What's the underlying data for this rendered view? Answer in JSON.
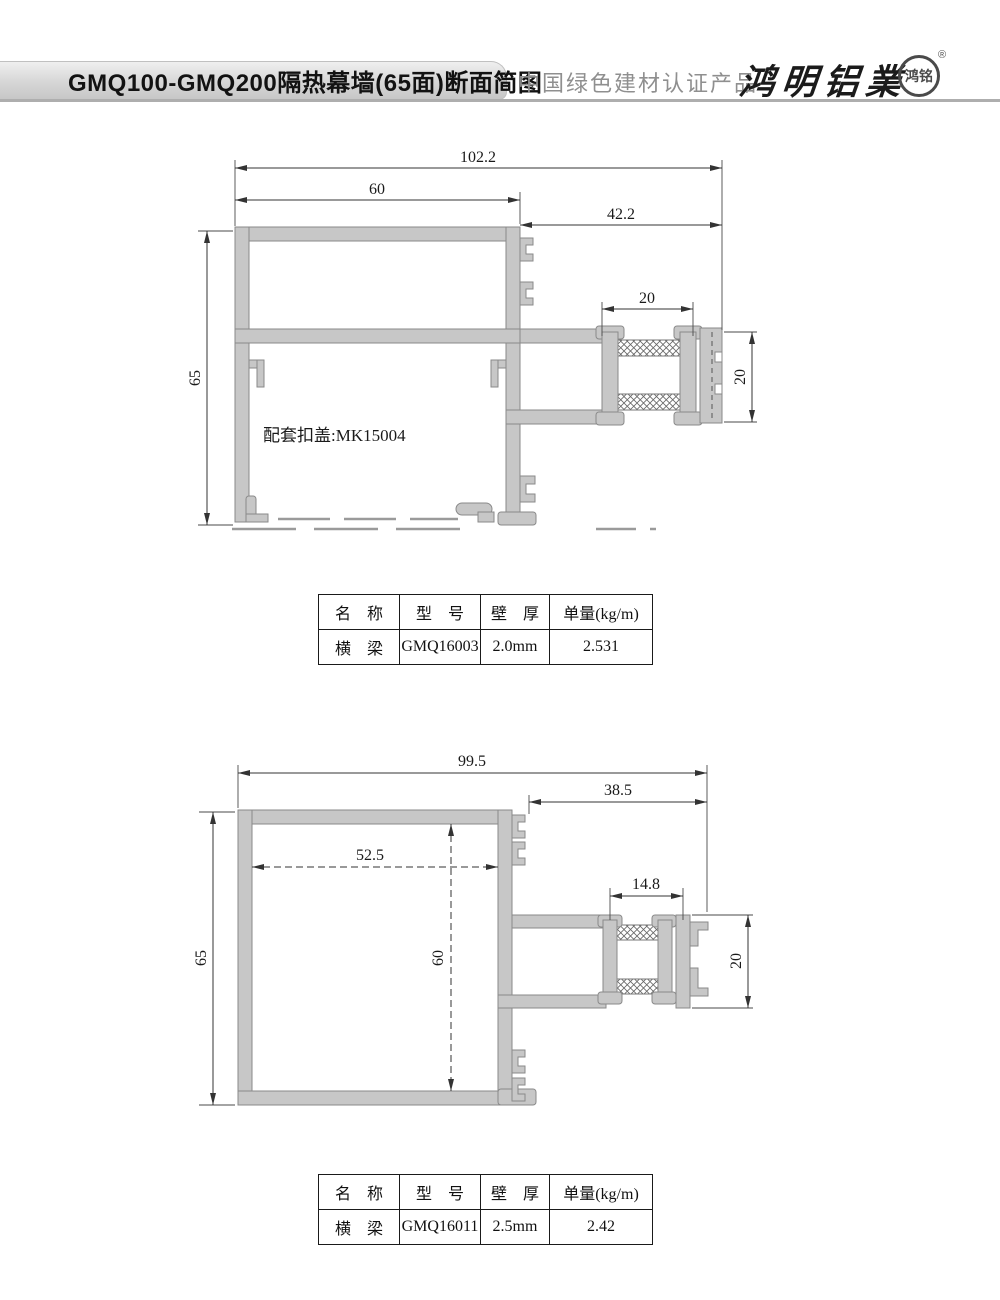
{
  "header": {
    "title": "GMQ100-GMQ200隔热幕墙(65面)断面简图",
    "certification": "中国绿色建材认证产品",
    "brand": "鸿明铝業",
    "brand_seal": "鸿铭",
    "registered_mark": "®"
  },
  "drawing1": {
    "dims": {
      "overall_width": "102.2",
      "top_width": "60",
      "right_width": "42.2",
      "height": "65",
      "break_width": "20",
      "break_height": "20"
    },
    "note": "配套扣盖:MK15004"
  },
  "table1": {
    "headers": [
      "名　称",
      "型　号",
      "壁　厚",
      "单量(kg/m)"
    ],
    "row": [
      "横　梁",
      "GMQ16003",
      "2.0mm",
      "2.531"
    ]
  },
  "drawing2": {
    "dims": {
      "overall_width": "99.5",
      "right_width": "38.5",
      "inner_width": "52.5",
      "height": "65",
      "inner_height": "60",
      "break_width": "14.8",
      "break_height": "20"
    }
  },
  "table2": {
    "headers": [
      "名　称",
      "型　号",
      "壁　厚",
      "单量(kg/m)"
    ],
    "row": [
      "横　梁",
      "GMQ16011",
      "2.5mm",
      "2.42"
    ]
  }
}
